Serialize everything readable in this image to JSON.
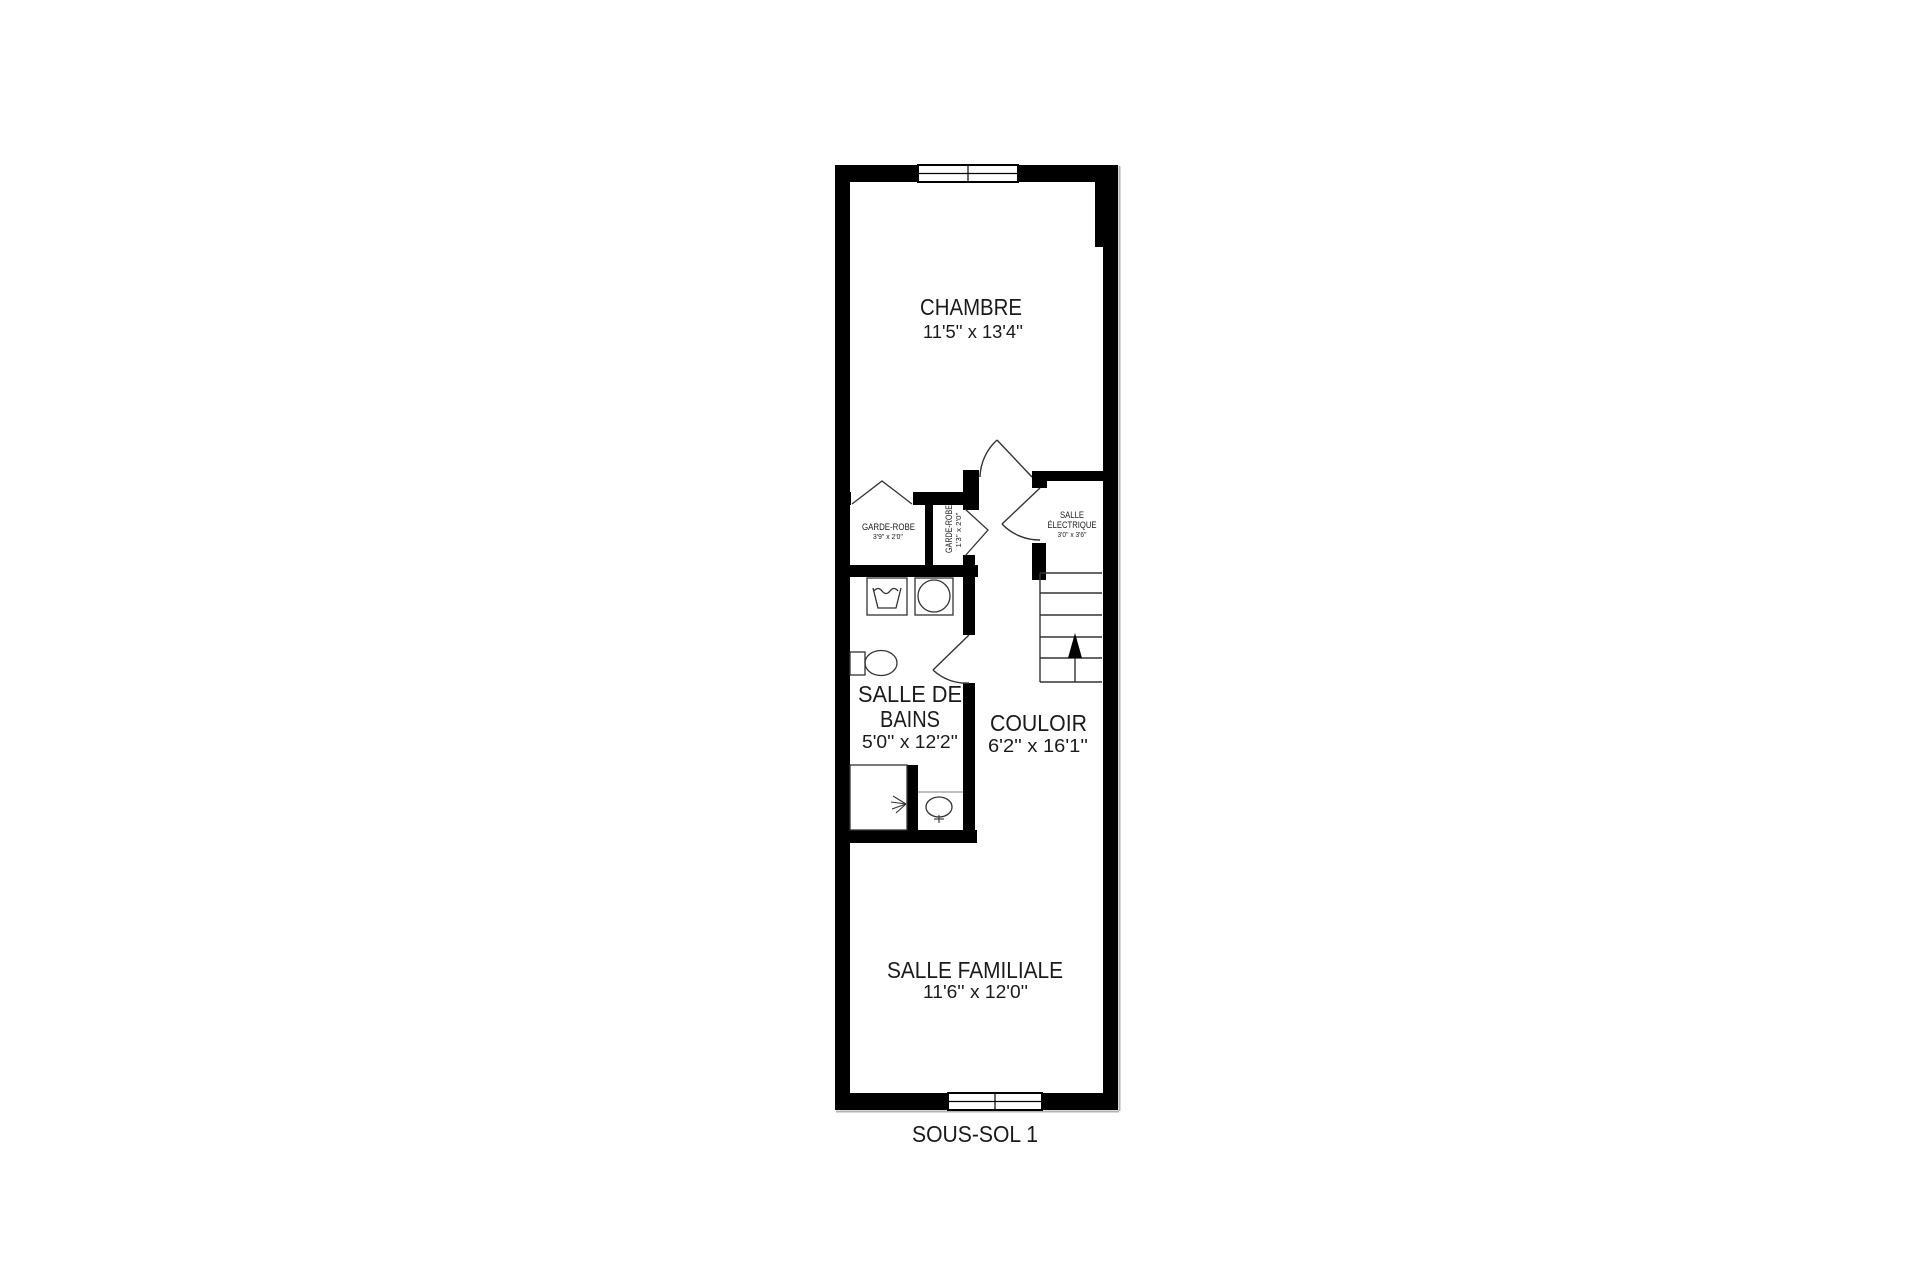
{
  "plan_title": "SOUS-SOL 1",
  "colors": {
    "wall": "#000000",
    "line": "#333333",
    "thin_gray": "#999999",
    "shadow_gray": "#b3b3b3",
    "background": "#ffffff",
    "text": "#1a1a1a"
  },
  "rooms": {
    "chambre": {
      "name": "CHAMBRE",
      "dims": "11'5'' x 13'4''"
    },
    "garde_robe": {
      "name": "GARDE-ROBE",
      "dims": "3'9'' x 2'0''"
    },
    "garde_robe_2": {
      "name": "GARDE-ROBE",
      "dims": "1'3'' x 2'0''"
    },
    "salle_electrique": {
      "name_line1": "SALLE",
      "name_line2": "ÉLECTRIQUE",
      "dims": "3'0'' x 3'6''"
    },
    "salle_de_bains": {
      "name_line1": "SALLE DE",
      "name_line2": "BAINS",
      "dims": "5'0'' x 12'2''"
    },
    "couloir": {
      "name": "COULOIR",
      "dims": "6'2'' x 16'1''"
    },
    "salle_familiale": {
      "name": "SALLE FAMILIALE",
      "dims": "11'6'' x 12'0''"
    }
  }
}
